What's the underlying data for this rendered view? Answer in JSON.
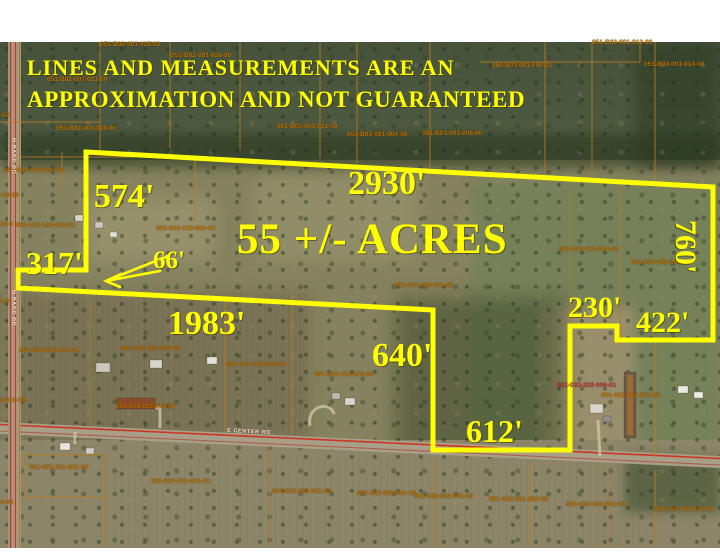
{
  "disclaimer": {
    "line1": "LINES AND MEASUREMENTS ARE AN",
    "line2": "APPROXIMATION AND NOT GUARANTEED"
  },
  "acreage_label": "55 +/- ACRES",
  "measurements": [
    {
      "name": "north-boundary",
      "text": "2930'"
    },
    {
      "name": "west-boundary",
      "text": "574'"
    },
    {
      "name": "west-jog",
      "text": "317'"
    },
    {
      "name": "access-strip-width",
      "text": "66'"
    },
    {
      "name": "south-long-boundary",
      "text": "1983'"
    },
    {
      "name": "south-vertical",
      "text": "640'"
    },
    {
      "name": "south-bottom",
      "text": "612'"
    },
    {
      "name": "east-jog",
      "text": "230'"
    },
    {
      "name": "east-bottom",
      "text": "422'"
    },
    {
      "name": "east-boundary",
      "text": "760'"
    }
  ],
  "roads": {
    "bottom_road_label": "E CENTER RD",
    "left_road_label": "N BARD RD"
  },
  "parcel_labels": [
    {
      "id": "051-B02-001-025-02",
      "x": 100,
      "y": 41
    },
    {
      "id": "051-B02-001-026-00",
      "x": 171,
      "y": 52
    },
    {
      "id": "051-B02-001-021-00",
      "x": 47,
      "y": 76
    },
    {
      "id": "051-B02-001-028-00",
      "x": 56,
      "y": 125
    },
    {
      "id": "051-B03-001-001-00",
      "x": 277,
      "y": 123
    },
    {
      "id": "051-B03-001-004-00",
      "x": 347,
      "y": 131
    },
    {
      "id": "051-B03-001-006-00",
      "x": 422,
      "y": 130
    },
    {
      "id": "051-B03-001-007-01",
      "x": 492,
      "y": 62
    },
    {
      "id": "051-B03-001-013-00",
      "x": 592,
      "y": 39
    },
    {
      "id": "051-B03-001-014-00",
      "x": 644,
      "y": 61
    },
    {
      "id": "051-033-103-001-00",
      "x": 4,
      "y": 167
    },
    {
      "id": "051-033-103-002-01",
      "x": 16,
      "y": 222
    },
    {
      "id": "051-033-103-002-02",
      "x": 156,
      "y": 225
    },
    {
      "id": "051-033-104-001-02",
      "x": 394,
      "y": 282
    },
    {
      "id": "051-033-202-004-00",
      "x": 559,
      "y": 246
    },
    {
      "id": "051-033-202-005-01",
      "x": 631,
      "y": 259
    },
    {
      "id": "051-033-103-003-00",
      "x": 19,
      "y": 347
    },
    {
      "id": "051-033-103-007-00",
      "x": 121,
      "y": 345
    },
    {
      "id": "051-033-103-006-00",
      "x": 226,
      "y": 361
    },
    {
      "id": "051-033-104-003-00",
      "x": 314,
      "y": 371
    },
    {
      "id": "051-033-202-006-01",
      "x": 557,
      "y": 382,
      "color": "#c0392b"
    },
    {
      "id": "051-033-102-001-02",
      "x": 601,
      "y": 392
    },
    {
      "id": "051-033-103-010-00",
      "x": 116,
      "y": 403
    },
    {
      "id": "051-033-301-001-04",
      "x": 29,
      "y": 464
    },
    {
      "id": "051-033-301-001-01",
      "x": 151,
      "y": 478
    },
    {
      "id": "051-033-302-001-01",
      "x": 272,
      "y": 488
    },
    {
      "id": "051-033-302-001-02",
      "x": 357,
      "y": 490
    },
    {
      "id": "051-033-302-001-03",
      "x": 414,
      "y": 493
    },
    {
      "id": "051-033-301-003-00",
      "x": 489,
      "y": 496
    },
    {
      "id": "051-033-401-001-00",
      "x": 566,
      "y": 501
    },
    {
      "id": "051-033-401-002-00",
      "x": 654,
      "y": 506
    }
  ],
  "edge_partial_labels": [
    {
      "text": "-02",
      "x": 0,
      "y": 112
    },
    {
      "text": "-03-00",
      "x": 0,
      "y": 192
    },
    {
      "text": "04-0",
      "x": 0,
      "y": 221
    },
    {
      "text": "1-0",
      "x": 0,
      "y": 298
    },
    {
      "text": "0-219-00",
      "x": 0,
      "y": 397
    },
    {
      "text": "4-00",
      "x": 0,
      "y": 499
    }
  ],
  "colors": {
    "boundary_yellow": "#ffff00",
    "parcel_line_orange": "#b97a1e",
    "parcel_text_orange": "#c27400",
    "road_line_red": "#cc3322",
    "label_yellow": "#ffff00"
  }
}
